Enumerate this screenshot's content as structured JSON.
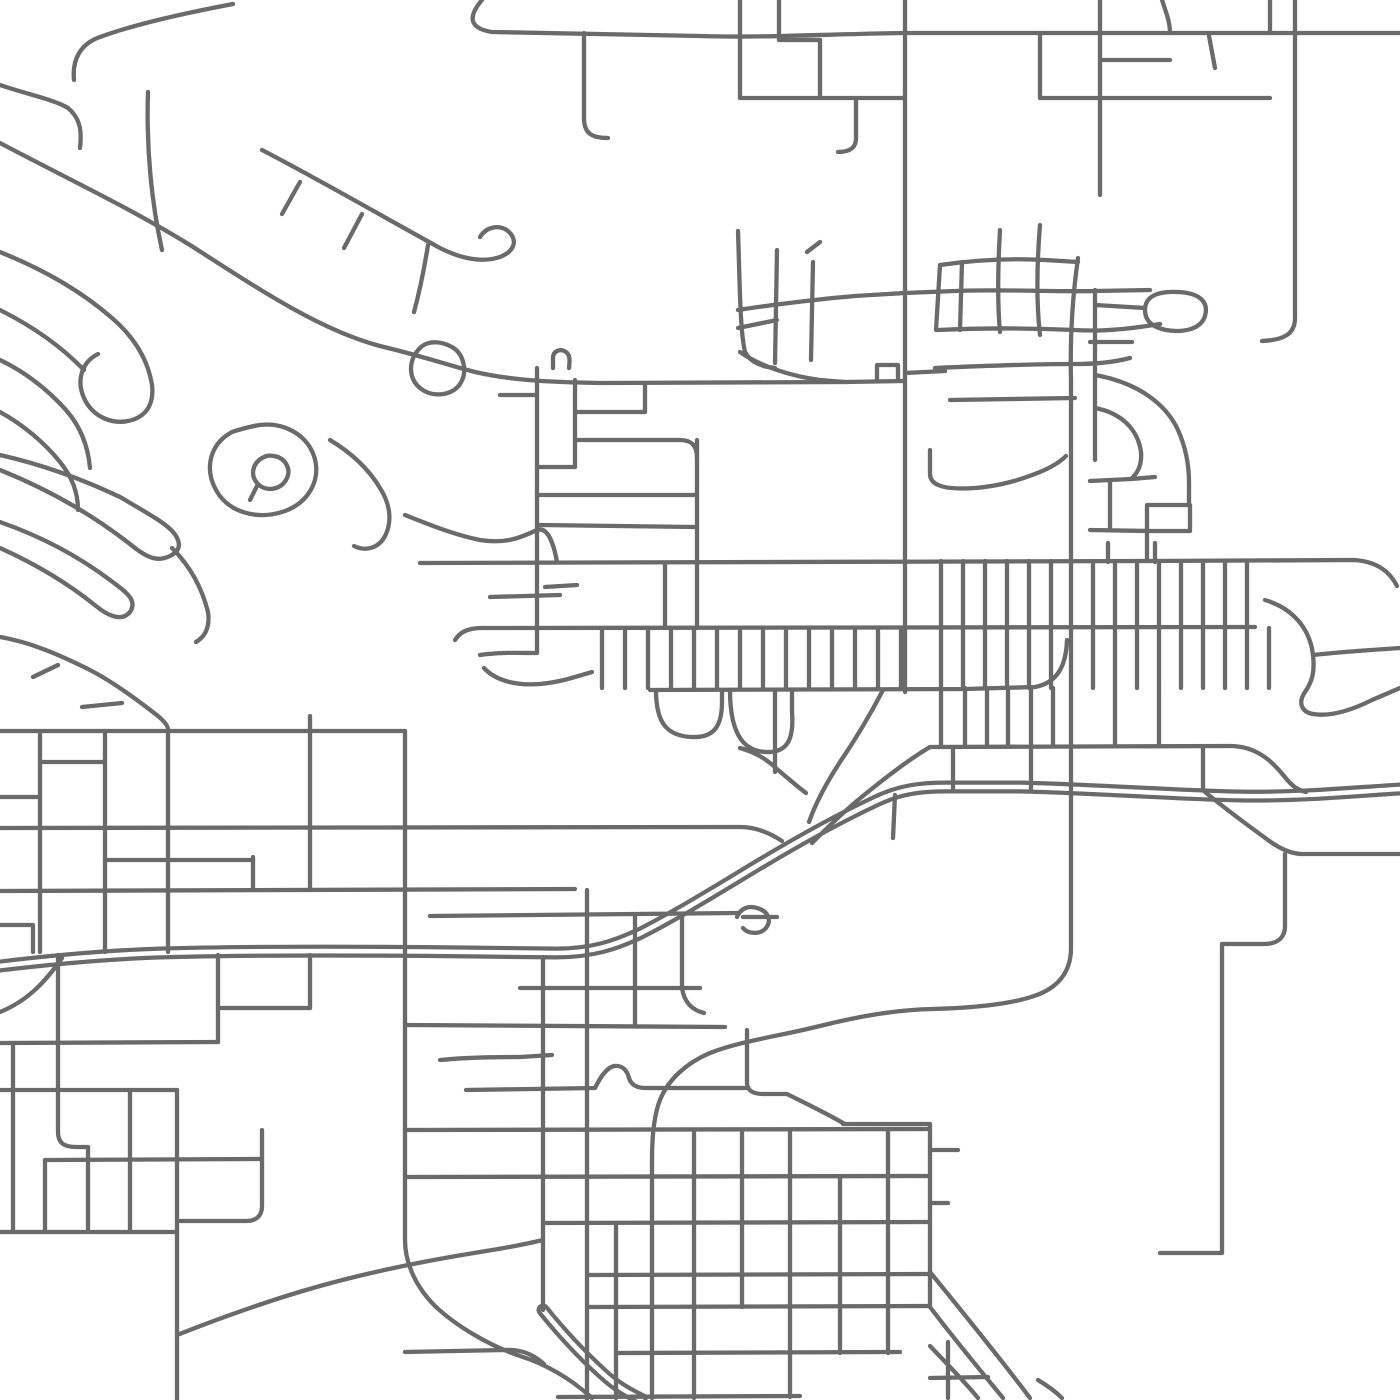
{
  "map": {
    "canvas": {
      "width": 1400,
      "height": 1400,
      "background": "#ffffff"
    },
    "style": {
      "road_color": "#6a6a6a",
      "road_width": 4.3,
      "highway_outer_width": 13,
      "highway_inner_width": 4.6,
      "linecap": "round",
      "linejoin": "round"
    },
    "highways": [
      {
        "id": "highway-main",
        "d": "M0,966 C50,960 100,955 160,953 C260,950 380,951 470,952 L556,953 C592,953 616,945 641,933 C680,913 720,888 760,864 C800,840 842,817 876,801 C901,789 922,787 946,787 L1020,787 C1100,789 1180,795 1240,796 C1300,797 1350,792 1400,789"
      },
      {
        "id": "highway-se-branch",
        "d": "M543,1310 C560,1331 580,1353 602,1373 C616,1386 628,1393 641,1399"
      }
    ],
    "roads": [
      {
        "id": "top-arterial",
        "d": "M482,0 C470,14 466,28 492,32 L700,36 C760,38 830,34 905,33 L1400,33"
      },
      {
        "id": "v-584",
        "d": "M584,33 L584,118 C584,132 590,138 608,138"
      },
      {
        "id": "v-740",
        "d": "M740,0 L740,98"
      },
      {
        "id": "v-779",
        "d": "M779,0 L779,40"
      },
      {
        "id": "h-779-820",
        "d": "M779,40 L820,40"
      },
      {
        "id": "v-820",
        "d": "M820,40 L820,98"
      },
      {
        "id": "h-98",
        "d": "M740,98 L905,98"
      },
      {
        "id": "v-856",
        "d": "M856,98 L856,138 C856,148 850,152 838,152"
      },
      {
        "id": "v-905",
        "d": "M905,0 L905,692"
      },
      {
        "id": "v-1040",
        "d": "M1040,33 L1040,98"
      },
      {
        "id": "v-1100",
        "d": "M1100,0 L1100,195"
      },
      {
        "id": "v-1162",
        "d": "M1162,0 C1166,12 1170,22 1170,33"
      },
      {
        "id": "v-1270",
        "d": "M1270,0 L1270,33"
      },
      {
        "id": "h-ne-98",
        "d": "M1040,98 L1270,98"
      },
      {
        "id": "h-ne-60",
        "d": "M1100,60 L1170,60"
      },
      {
        "id": "stub-ne",
        "d": "M1209,36 L1215,68"
      },
      {
        "id": "v-1295",
        "d": "M1295,0 L1295,318 C1295,334 1284,340 1262,341"
      },
      {
        "id": "cluster-a",
        "d": "M738,231 C740,290 740,330 745,352 C750,362 762,367 775,368"
      },
      {
        "id": "cluster-b",
        "d": "M777,250 L775,363"
      },
      {
        "id": "cluster-stub",
        "d": "M807,252 L820,242"
      },
      {
        "id": "cluster-c",
        "d": "M813,262 L811,360"
      },
      {
        "id": "cluster-h1",
        "d": "M738,310 C770,305 820,299 855,296 L905,293 L955,291 C1000,289 1050,292 1095,291 L1150,290"
      },
      {
        "id": "cluster-h2",
        "d": "M738,328 L777,320"
      },
      {
        "id": "cluster-bottom",
        "d": "M740,352 C760,366 790,376 820,380 L845,382"
      },
      {
        "id": "main-diagonal",
        "d": "M0,143 C70,180 130,208 190,245 C260,290 320,330 380,346 C430,358 450,366 475,372 C510,380 545,382 600,383 L845,382 L905,381"
      },
      {
        "id": "notch",
        "d": "M877,381 L877,365 L898,365 L898,381"
      },
      {
        "id": "h-373",
        "d": "M905,373 L945,371"
      },
      {
        "id": "sub-cross1",
        "d": "M148,92 C146,150 152,205 162,250"
      },
      {
        "id": "sub-hook-left",
        "d": "M0,85 C30,95 55,100 68,108 C80,118 82,130 80,148"
      },
      {
        "id": "sub-top",
        "d": "M233,4 C180,14 130,26 100,37 C80,44 72,60 74,80"
      },
      {
        "id": "sub-parallel",
        "d": "M262,150 C320,180 380,215 440,248 C462,259 482,263 500,257 C515,251 518,240 508,231 C499,224 486,227 480,237"
      },
      {
        "id": "sub-tick1",
        "d": "M300,182 L282,214"
      },
      {
        "id": "sub-tick2",
        "d": "M362,214 L344,248"
      },
      {
        "id": "sub-conn",
        "d": "M428,245 C424,270 420,290 414,312"
      },
      {
        "id": "teardrop-road",
        "d": "M420,348 C408,360 408,378 420,388 C432,398 452,396 460,384 C468,372 464,354 452,347 C441,341 428,340 420,348"
      },
      {
        "id": "loop-nw",
        "d": "M0,252 C40,268 80,290 112,318 C134,337 148,360 152,385 C154,402 148,415 132,420 C112,426 92,416 84,398 C76,380 82,362 98,354"
      },
      {
        "id": "loop-nw2",
        "d": "M0,310 C30,325 60,345 84,370"
      },
      {
        "id": "loop-nw3",
        "d": "M0,360 C25,372 48,390 66,410 C80,426 88,445 90,468"
      },
      {
        "id": "loop-nw4",
        "d": "M0,412 C22,424 44,442 60,462 C72,477 78,492 78,510"
      },
      {
        "id": "teardrop-small",
        "d": "M262,458 C252,464 250,476 258,484 C266,492 280,490 286,480 C292,470 286,458 274,456 C268,455 266,456 262,458 M258,484 L250,500"
      },
      {
        "id": "blob-road",
        "d": "M232,432 C210,444 204,468 216,490 C228,512 256,520 282,512 C308,504 322,480 314,456 C306,432 278,420 254,426 C245,428 238,430 232,432"
      },
      {
        "id": "squiggle",
        "d": "M330,440 C350,452 368,468 380,488 C390,504 392,520 386,534 C380,548 366,552 354,546"
      },
      {
        "id": "arrow-a",
        "d": "M0,455 C40,464 80,478 120,497 C156,518 170,526 176,536 C182,546 178,552 170,556 C158,562 148,558 135,548 C100,520 55,492 0,470"
      },
      {
        "id": "arrow-b",
        "d": "M0,548 C40,566 70,585 96,606 C108,616 122,622 130,612 C138,600 126,592 110,580 C78,556 40,536 0,522"
      },
      {
        "id": "pencil-road",
        "d": "M172,548 C190,566 202,588 208,612 C210,626 206,636 196,642"
      },
      {
        "id": "wave-540",
        "d": "M405,515 C430,525 455,535 480,540 C505,544 520,538 537,530 C548,526 554,545 557,562"
      },
      {
        "id": "main-560",
        "d": "M420,563 L1150,561 L1355,560 C1378,562 1390,572 1397,586"
      },
      {
        "id": "ladder-v537",
        "d": "M537,368 L537,653"
      },
      {
        "id": "ladder-v575",
        "d": "M575,380 L575,467"
      },
      {
        "id": "ladder-r412",
        "d": "M575,412 L645,412"
      },
      {
        "id": "ladder-v645",
        "d": "M645,385 L645,412"
      },
      {
        "id": "ladder-r440",
        "d": "M578,440 L680,440 C692,440 697,446 697,458"
      },
      {
        "id": "ladder-v697",
        "d": "M697,440 L697,628"
      },
      {
        "id": "ladder-jog",
        "d": "M537,467 L575,467"
      },
      {
        "id": "ladder-r495",
        "d": "M537,495 L697,495"
      },
      {
        "id": "ladder-r525",
        "d": "M540,525 L695,527"
      },
      {
        "id": "ladder-stub",
        "d": "M500,395 L537,395"
      },
      {
        "id": "ladder-bump",
        "d": "M553,368 L553,358 C553,351 560,348 566,352 C570,355 570,360 569,368"
      },
      {
        "id": "ladder-r585",
        "d": "M545,587 L577,585"
      },
      {
        "id": "ladder-r595",
        "d": "M490,597 L560,595"
      },
      {
        "id": "h-653",
        "d": "M480,655 C500,652 520,653 537,653"
      },
      {
        "id": "island-curve",
        "d": "M484,668 C495,680 515,686 540,684 C562,682 578,676 592,672"
      },
      {
        "id": "ladder-v665",
        "d": "M665,563 L665,628"
      },
      {
        "id": "h-628",
        "d": "M455,640 C460,632 468,628 482,628 L1255,627"
      },
      {
        "id": "h-688",
        "d": "M650,690 L965,689 L1035,687 C1056,683 1066,668 1067,640"
      },
      {
        "id": "h-746",
        "d": "M930,747 L1230,746 C1256,746 1272,761 1284,776 C1291,785 1297,790 1306,792"
      },
      {
        "id": "pouch-1",
        "d": "M656,690 C656,722 666,736 692,737 C714,738 722,726 722,702 L722,690"
      },
      {
        "id": "pouch-2",
        "d": "M730,690 C730,738 746,753 770,752 C788,751 794,738 792,712 L792,690"
      },
      {
        "id": "v-775b",
        "d": "M775,690 L775,772"
      },
      {
        "id": "diag-x1",
        "d": "M883,690 C870,715 855,740 840,762 C825,785 815,805 809,822"
      },
      {
        "id": "diag-x2",
        "d": "M930,747 C905,762 880,782 858,800 C840,815 824,831 812,843"
      },
      {
        "id": "v-893",
        "d": "M895,795 L893,838"
      },
      {
        "id": "old-hwy-link",
        "d": "M740,748 C755,752 768,760 778,770 C790,780 798,787 806,793"
      },
      {
        "id": "hwy-stub",
        "d": "M743,917 L777,917"
      },
      {
        "id": "hwy-loop",
        "d": "M737,917 C740,909 748,905 757,908 C768,911 772,920 766,928 C760,935 748,934 743,928"
      },
      {
        "id": "h-828",
        "d": "M0,828 L740,827 C756,827 770,833 782,841"
      },
      {
        "id": "h-890",
        "d": "M0,891 L575,889"
      },
      {
        "id": "h-915",
        "d": "M430,916 L737,913"
      },
      {
        "id": "h-731",
        "d": "M0,731 L405,731"
      },
      {
        "id": "h-762",
        "d": "M40,762 L105,762"
      },
      {
        "id": "h-797",
        "d": "M0,797 L40,797"
      },
      {
        "id": "h-860",
        "d": "M105,860 L253,860"
      },
      {
        "id": "v-40",
        "d": "M40,731 L40,952"
      },
      {
        "id": "v-105",
        "d": "M105,731 L105,952"
      },
      {
        "id": "v-168",
        "d": "M168,731 L168,952"
      },
      {
        "id": "v-253",
        "d": "M253,857 L253,890"
      },
      {
        "id": "v-310",
        "d": "M310,731 L310,890"
      },
      {
        "id": "stub-310",
        "d": "M310,716 L310,731"
      },
      {
        "id": "hill-road",
        "d": "M0,637 C30,642 60,655 90,670 C115,683 140,702 158,716 C165,722 169,727 168,731"
      },
      {
        "id": "hill-spur1",
        "d": "M33,677 L58,665"
      },
      {
        "id": "hill-spur2",
        "d": "M82,707 L122,703"
      },
      {
        "id": "v-405",
        "d": "M405,731 L405,1240 C405,1262 415,1286 435,1306 C456,1326 490,1346 520,1356 C545,1364 570,1378 592,1398"
      },
      {
        "id": "corner-33",
        "d": "M0,925 L33,925 L33,952"
      },
      {
        "id": "v-543",
        "d": "M543,957 L543,1310"
      },
      {
        "id": "h-1352",
        "d": "M405,1352 L505,1350 C522,1349 534,1355 544,1364"
      },
      {
        "id": "v-587",
        "d": "M587,890 L587,1400"
      },
      {
        "id": "v-635",
        "d": "M635,915 L635,1025"
      },
      {
        "id": "v-682",
        "d": "M682,915 L682,988 C684,1002 692,1010 704,1013"
      },
      {
        "id": "h-988",
        "d": "M520,988 L700,988"
      },
      {
        "id": "h-1025",
        "d": "M405,1025 L725,1027"
      },
      {
        "id": "h-1057",
        "d": "M440,1060 C470,1057 500,1057 520,1057 L552,1055"
      },
      {
        "id": "h-1088",
        "d": "M466,1090 L595,1088 C600,1078 606,1068 614,1066 C622,1065 627,1070 629,1078 C631,1085 637,1088 646,1088 L747,1088"
      },
      {
        "id": "v-747",
        "d": "M747,1030 L747,1082 C747,1091 753,1094 764,1094 L787,1094"
      },
      {
        "id": "diag-1093",
        "d": "M787,1094 C805,1103 826,1113 843,1123"
      },
      {
        "id": "h-1124",
        "d": "M843,1124 L930,1124"
      },
      {
        "id": "v-930",
        "d": "M930,1124 L930,1307"
      },
      {
        "id": "stub-1150",
        "d": "M930,1150 L958,1150"
      },
      {
        "id": "stub-1203",
        "d": "M930,1203 L948,1203"
      },
      {
        "id": "h-1130",
        "d": "M405,1130 L930,1129"
      },
      {
        "id": "h-1177",
        "d": "M405,1177 L930,1176"
      },
      {
        "id": "h-1223",
        "d": "M543,1223 L930,1222"
      },
      {
        "id": "h-1275",
        "d": "M587,1275 L930,1274"
      },
      {
        "id": "h-1307",
        "d": "M587,1307 L930,1306"
      },
      {
        "id": "h-1353",
        "d": "M616,1353 L900,1352"
      },
      {
        "id": "h-1397",
        "d": "M558,1397 L800,1396"
      },
      {
        "id": "v-616",
        "d": "M616,1223 L616,1398"
      },
      {
        "id": "v-694",
        "d": "M694,1130 L694,1398"
      },
      {
        "id": "v-742",
        "d": "M742,1130 L742,1307"
      },
      {
        "id": "v-790",
        "d": "M790,1130 L790,1397"
      },
      {
        "id": "v-840",
        "d": "M840,1177 L840,1353"
      },
      {
        "id": "v-888",
        "d": "M888,1130 L888,1353"
      },
      {
        "id": "curve-1012",
        "d": "M0,1012 C30,1000 48,978 62,958"
      },
      {
        "id": "h-1043",
        "d": "M0,1043 L218,1042"
      },
      {
        "id": "h-1090",
        "d": "M0,1090 L177,1090"
      },
      {
        "id": "v-58",
        "d": "M58,955 L58,1132 C58,1143 64,1147 76,1147 L88,1147"
      },
      {
        "id": "v-88",
        "d": "M88,1147 L88,1232"
      },
      {
        "id": "v-13",
        "d": "M13,1043 L13,1232"
      },
      {
        "id": "v-130",
        "d": "M130,1090 L130,1232"
      },
      {
        "id": "h-1160",
        "d": "M45,1160 L262,1159"
      },
      {
        "id": "v-45",
        "d": "M45,1160 L45,1232"
      },
      {
        "id": "h-1232",
        "d": "M0,1232 L177,1232"
      },
      {
        "id": "v-177",
        "d": "M177,1090 L177,1400"
      },
      {
        "id": "v-262",
        "d": "M262,1130 L262,1206 C262,1216 256,1221 246,1221 L180,1221"
      },
      {
        "id": "diag-sw",
        "d": "M177,1335 C220,1318 270,1300 320,1286 C370,1272 430,1260 480,1252 C506,1248 526,1244 543,1240"
      },
      {
        "id": "fan-1",
        "d": "M930,1272 C965,1315 1000,1358 1030,1398"
      },
      {
        "id": "fan-2",
        "d": "M930,1307 C955,1340 980,1370 1003,1398"
      },
      {
        "id": "fan-3",
        "d": "M930,1346 C948,1365 965,1382 978,1398"
      },
      {
        "id": "fan-v",
        "d": "M948,1342 L948,1398"
      },
      {
        "id": "fan-h",
        "d": "M930,1378 L988,1377"
      },
      {
        "id": "fan-c",
        "d": "M1038,1380 C1048,1386 1056,1392 1062,1398"
      },
      {
        "id": "east-cluster-v1",
        "d": "M962,262 L960,330"
      },
      {
        "id": "east-cluster-v2",
        "d": "M1000,230 C998,265 997,300 1000,332"
      },
      {
        "id": "east-cluster-v3",
        "d": "M1040,225 C1037,262 1036,300 1040,335"
      },
      {
        "id": "east-cluster-h1",
        "d": "M940,265 C975,260 1010,258 1045,260 L1078,262"
      },
      {
        "id": "east-cluster-h3",
        "d": "M938,330 C980,328 1030,328 1075,330 C1105,332 1135,328 1160,324"
      },
      {
        "id": "east-cluster-h4",
        "d": "M935,368 C980,366 1030,364 1075,364 C1095,364 1115,362 1130,358"
      },
      {
        "id": "east-cluster-h5",
        "d": "M950,400 L1075,398"
      },
      {
        "id": "east-cluster-j",
        "d": "M930,450 L930,474 C930,486 946,490 975,488 C1000,486 1020,480 1040,472 C1052,467 1060,462 1066,456"
      },
      {
        "id": "east-cluster-left",
        "d": "M940,265 L936,330"
      },
      {
        "id": "right-v1095",
        "d": "M1095,290 L1095,460"
      },
      {
        "id": "right-rung",
        "d": "M1090,342 L1132,342"
      },
      {
        "id": "right-teardrop",
        "d": "M1145,310 C1145,296 1158,291 1178,292 C1200,293 1209,302 1205,316 C1201,329 1184,333 1166,330 C1151,327 1145,320 1145,310"
      },
      {
        "id": "right-link",
        "d": "M1095,305 L1145,308"
      },
      {
        "id": "right-arc-outer",
        "d": "M1095,375 C1135,382 1165,402 1178,430 C1186,448 1189,465 1189,482 L1189,505"
      },
      {
        "id": "right-arc-inner",
        "d": "M1095,408 C1122,413 1138,430 1141,452 C1142,464 1138,473 1131,479"
      },
      {
        "id": "right-diag",
        "d": "M1131,479 L1155,477"
      },
      {
        "id": "right-h478",
        "d": "M1090,481 L1131,479"
      },
      {
        "id": "right-v1110",
        "d": "M1110,481 L1110,530"
      },
      {
        "id": "right-h530",
        "d": "M1090,530 L1147,531"
      },
      {
        "id": "right-box",
        "d": "M1147,561 L1147,505 L1190,505 L1190,531 L1147,531"
      },
      {
        "id": "east-arc",
        "d": "M1265,600 C1292,608 1310,628 1313,655 C1315,672 1312,682 1305,692 C1298,702 1301,712 1313,714 C1331,717 1352,710 1372,700 L1400,688"
      },
      {
        "id": "east-spur",
        "d": "M1313,655 C1340,652 1370,650 1400,648"
      },
      {
        "id": "se-diag",
        "d": "M1205,792 C1222,806 1246,824 1268,840 C1280,849 1290,853 1300,854"
      },
      {
        "id": "se-h855",
        "d": "M1300,854 L1400,854"
      },
      {
        "id": "se-v1285",
        "d": "M1285,854 L1285,926 C1285,938 1277,944 1264,944 L1222,944"
      },
      {
        "id": "se-v1218",
        "d": "M1222,944 L1222,1253 L1160,1253"
      },
      {
        "id": "collector-s-curve",
        "d": "M1078,258 C1072,300 1070,340 1071,380 L1071,948 C1071,972 1058,988 1034,996 C1008,1005 970,1008 932,1009 C895,1010 860,1016 820,1026 C780,1036 740,1041 710,1053 C686,1063 668,1080 660,1100 C654,1115 652,1136 652,1160 L652,1398"
      },
      {
        "id": "nw-v218",
        "d": "M218,955 L218,1042"
      },
      {
        "id": "nw-v310",
        "d": "M310,955 L310,1008"
      },
      {
        "id": "nw-h1008",
        "d": "M218,1008 L310,1008"
      }
    ],
    "tick_groups": [
      {
        "id": "ticks-band-628-688",
        "y1": 628,
        "y2": 688,
        "xs": [
          602,
          625,
          648,
          671,
          694,
          717,
          740,
          763,
          786,
          809,
          832,
          855,
          878,
          901
        ]
      },
      {
        "id": "ticks-downtown-561-628",
        "y1": 561,
        "y2": 628,
        "xs": [
          941,
          963,
          985,
          1007,
          1029,
          1051,
          1093,
          1115,
          1137,
          1159,
          1181,
          1203,
          1225,
          1247
        ]
      },
      {
        "id": "ticks-downtown-628-688",
        "y1": 628,
        "y2": 688,
        "xs": [
          941,
          963,
          985,
          1007,
          1029,
          1051,
          1093,
          1115,
          1137,
          1159,
          1181,
          1203,
          1225,
          1247,
          1269
        ]
      },
      {
        "id": "ticks-downtown-688-746",
        "y1": 688,
        "y2": 746,
        "xs": [
          941,
          965,
          987,
          1008,
          1031,
          1053,
          1115,
          1159
        ]
      },
      {
        "id": "ticks-to-highway",
        "y1": 747,
        "y2": 789,
        "xs": [
          953,
          1031,
          1203
        ]
      },
      {
        "id": "ticks-above-561",
        "y1": 543,
        "y2": 562,
        "xs": [
          1108,
          1155
        ]
      }
    ]
  }
}
